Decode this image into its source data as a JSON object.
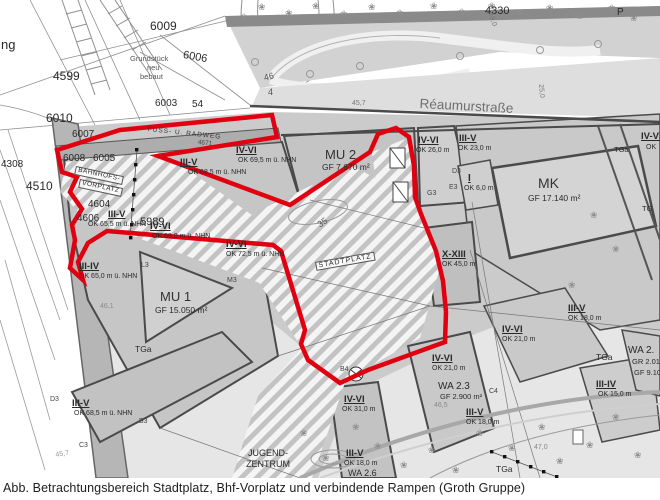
{
  "figure": {
    "caption": "Abb. Betrachtungsbereich Stadtplatz, Bhf-Vorplatz und verbindende Rampen (Groth Gruppe)"
  },
  "colors": {
    "study_area_outline": "#e10010",
    "street_fill": "#dedede",
    "parcel_dark_line": "#4a4a4a"
  },
  "map": {
    "street_name": "Réaumurstraße",
    "labels": [
      {
        "t": "ng",
        "x": 1,
        "y": 38,
        "s": 13
      },
      {
        "t": "6009",
        "x": 150,
        "y": 20,
        "s": 12
      },
      {
        "t": "4599",
        "x": 53,
        "y": 70,
        "s": 12
      },
      {
        "t": "Grundstück",
        "x": 130,
        "y": 55,
        "s": 7.5,
        "c": "#555"
      },
      {
        "t": "neu",
        "x": 147,
        "y": 64,
        "s": 7.5,
        "c": "#555"
      },
      {
        "t": "bebaut",
        "x": 140,
        "y": 73,
        "s": 7.5,
        "c": "#555"
      },
      {
        "t": "6006",
        "x": 184,
        "y": 50,
        "s": 11,
        "r": 10
      },
      {
        "t": "6003",
        "x": 155,
        "y": 99,
        "s": 10
      },
      {
        "t": "54",
        "x": 192,
        "y": 100,
        "s": 10
      },
      {
        "t": "6010",
        "x": 46,
        "y": 112,
        "s": 12
      },
      {
        "t": "6007",
        "x": 72,
        "y": 130,
        "s": 10
      },
      {
        "t": "4330",
        "x": 485,
        "y": 6,
        "s": 11
      },
      {
        "t": "P",
        "x": 617,
        "y": 8,
        "s": 10
      },
      {
        "t": "Réaumurstraße",
        "x": 420,
        "y": 97,
        "s": 13.5,
        "c": "#6f6f6f",
        "r": 3
      },
      {
        "t": "45,7",
        "x": 352,
        "y": 100,
        "s": 7,
        "c": "#777"
      },
      {
        "t": "46",
        "x": 263,
        "y": 74,
        "s": 9,
        "c": "#555",
        "r": -15
      },
      {
        "t": "4",
        "x": 268,
        "y": 88,
        "s": 9,
        "c": "#555"
      },
      {
        "t": "FUSS- U. RADWEG",
        "x": 148,
        "y": 127,
        "s": 6.5,
        "r": 6,
        "ls": 1,
        "c": "#333"
      },
      {
        "t": "4671",
        "x": 198,
        "y": 140,
        "s": 6.5,
        "r": 6,
        "c": "#444"
      },
      {
        "t": "4308",
        "x": 1,
        "y": 160,
        "s": 10
      },
      {
        "t": "6008",
        "x": 63,
        "y": 154,
        "s": 10
      },
      {
        "t": "6005",
        "x": 93,
        "y": 154,
        "s": 10
      },
      {
        "t": "BAHNHOFS-",
        "x": 76,
        "y": 166,
        "s": 6.5,
        "r": 12,
        "ls": 0.5,
        "box": 1
      },
      {
        "t": "VORPLATZ",
        "x": 80,
        "y": 179,
        "s": 6.5,
        "r": 12,
        "ls": 0.5,
        "box": 1
      },
      {
        "t": "4510",
        "x": 26,
        "y": 180,
        "s": 12
      },
      {
        "t": "4604",
        "x": 88,
        "y": 200,
        "s": 10
      },
      {
        "t": "4606",
        "x": 77,
        "y": 214,
        "s": 10
      },
      {
        "t": "5989",
        "x": 140,
        "y": 217,
        "s": 11
      },
      {
        "t": "III-V",
        "x": 180,
        "y": 158,
        "s": 9.5,
        "w": 1,
        "u": 1
      },
      {
        "t": "OK 68,5 m ü. NHN",
        "x": 188,
        "y": 169,
        "s": 7
      },
      {
        "t": "IV-VI",
        "x": 236,
        "y": 146,
        "s": 9.5,
        "w": 1,
        "u": 1
      },
      {
        "t": "OK 69,5 m ü. NHN",
        "x": 238,
        "y": 157,
        "s": 7
      },
      {
        "t": "MU 2",
        "x": 325,
        "y": 148,
        "s": 13,
        "c": "#333"
      },
      {
        "t": "GF 7.670 m²",
        "x": 322,
        "y": 163,
        "s": 8.5
      },
      {
        "t": "IV-VI",
        "x": 418,
        "y": 136,
        "s": 9.5,
        "w": 1,
        "u": 1
      },
      {
        "t": "OK 26,0 m",
        "x": 416,
        "y": 147,
        "s": 7
      },
      {
        "t": "III-V",
        "x": 459,
        "y": 134,
        "s": 9.5,
        "w": 1,
        "u": 1
      },
      {
        "t": "OK 23,0 m",
        "x": 458,
        "y": 145,
        "s": 7
      },
      {
        "t": "I",
        "x": 468,
        "y": 174,
        "s": 10,
        "w": 1,
        "u": 1
      },
      {
        "t": "OK 6,0 m",
        "x": 464,
        "y": 185,
        "s": 7
      },
      {
        "t": "MK",
        "x": 538,
        "y": 176,
        "s": 14,
        "c": "#333"
      },
      {
        "t": "GF 17.140 m²",
        "x": 528,
        "y": 194,
        "s": 8.5
      },
      {
        "t": "TGa",
        "x": 614,
        "y": 146,
        "s": 7.5
      },
      {
        "t": "TG",
        "x": 642,
        "y": 205,
        "s": 7.5
      },
      {
        "t": "IV-VI",
        "x": 641,
        "y": 132,
        "s": 9.5,
        "w": 1,
        "u": 1
      },
      {
        "t": "OK",
        "x": 646,
        "y": 144,
        "s": 7
      },
      {
        "t": "X-XIII",
        "x": 442,
        "y": 250,
        "s": 9.5,
        "w": 1,
        "u": 1
      },
      {
        "t": "OK 45,0 m",
        "x": 442,
        "y": 261,
        "s": 7
      },
      {
        "t": "IV-VI",
        "x": 226,
        "y": 240,
        "s": 9.5,
        "w": 1,
        "u": 1
      },
      {
        "t": "OK 72,5 m ü. NHN",
        "x": 226,
        "y": 251,
        "s": 7
      },
      {
        "t": "III-V",
        "x": 108,
        "y": 210,
        "s": 9.5,
        "w": 1,
        "u": 1
      },
      {
        "t": "OK 65,5 m ü. NHN",
        "x": 88,
        "y": 221,
        "s": 7
      },
      {
        "t": "IV-VI",
        "x": 150,
        "y": 222,
        "s": 9.5,
        "w": 1,
        "u": 1
      },
      {
        "t": "OK 69,0 m ü. NHN",
        "x": 152,
        "y": 233,
        "s": 7
      },
      {
        "t": "III-IV",
        "x": 79,
        "y": 262,
        "s": 9.5,
        "w": 1,
        "u": 1
      },
      {
        "t": "OK 65,0 m ü. NHN",
        "x": 79,
        "y": 273,
        "s": 7
      },
      {
        "t": "MU 1",
        "x": 160,
        "y": 290,
        "s": 13,
        "c": "#333"
      },
      {
        "t": "GF 15.050 m²",
        "x": 155,
        "y": 306,
        "s": 8.5
      },
      {
        "t": "46,1",
        "x": 100,
        "y": 303,
        "s": 7,
        "c": "#888"
      },
      {
        "t": "TGa",
        "x": 135,
        "y": 345,
        "s": 8.5
      },
      {
        "t": "35",
        "x": 316,
        "y": 222,
        "s": 9,
        "r": -35,
        "c": "#555"
      },
      {
        "t": "STADTPLATZ",
        "x": 315,
        "y": 262,
        "s": 7,
        "r": -10,
        "ls": 1,
        "box": 1
      },
      {
        "t": "III-V",
        "x": 72,
        "y": 399,
        "s": 9.5,
        "w": 1,
        "u": 1
      },
      {
        "t": "OK 68,5 m ü. NHN",
        "x": 74,
        "y": 410,
        "s": 7
      },
      {
        "t": "B3",
        "x": 139,
        "y": 418,
        "s": 7,
        "c": "#444"
      },
      {
        "t": "C3",
        "x": 79,
        "y": 442,
        "s": 7,
        "c": "#444"
      },
      {
        "t": "D3",
        "x": 50,
        "y": 396,
        "s": 7,
        "c": "#444"
      },
      {
        "t": "45,7",
        "x": 55,
        "y": 452,
        "s": 7,
        "c": "#999",
        "r": -10
      },
      {
        "t": "JUGEND-",
        "x": 248,
        "y": 449,
        "s": 9
      },
      {
        "t": "ZENTRUM",
        "x": 246,
        "y": 460,
        "s": 9
      },
      {
        "t": "B4",
        "x": 340,
        "y": 366,
        "s": 7,
        "c": "#444"
      },
      {
        "t": "IV-VI",
        "x": 344,
        "y": 395,
        "s": 9.5,
        "w": 1,
        "u": 1
      },
      {
        "t": "OK 31,0 m",
        "x": 342,
        "y": 406,
        "s": 7
      },
      {
        "t": "III-V",
        "x": 346,
        "y": 449,
        "s": 9.5,
        "w": 1,
        "u": 1
      },
      {
        "t": "OK 18,0 m",
        "x": 344,
        "y": 460,
        "s": 7
      },
      {
        "t": "WA 2.6",
        "x": 348,
        "y": 469,
        "s": 9
      },
      {
        "t": "IV-VI",
        "x": 432,
        "y": 354,
        "s": 9.5,
        "w": 1,
        "u": 1
      },
      {
        "t": "OK 21,0 m",
        "x": 432,
        "y": 365,
        "s": 7
      },
      {
        "t": "WA 2.3",
        "x": 438,
        "y": 382,
        "s": 10
      },
      {
        "t": "GF 2.900 m²",
        "x": 440,
        "y": 393,
        "s": 7.5
      },
      {
        "t": "C4",
        "x": 489,
        "y": 388,
        "s": 7,
        "c": "#444"
      },
      {
        "t": "III-V",
        "x": 466,
        "y": 408,
        "s": 9.5,
        "w": 1,
        "u": 1
      },
      {
        "t": "OK 18,0 m",
        "x": 466,
        "y": 419,
        "s": 7
      },
      {
        "t": "IV-VI",
        "x": 502,
        "y": 325,
        "s": 9.5,
        "w": 1,
        "u": 1
      },
      {
        "t": "OK 21,0 m",
        "x": 502,
        "y": 336,
        "s": 7
      },
      {
        "t": "III-V",
        "x": 568,
        "y": 304,
        "s": 9.5,
        "w": 1,
        "u": 1
      },
      {
        "t": "OK 18,0 m",
        "x": 568,
        "y": 315,
        "s": 7
      },
      {
        "t": "TGa",
        "x": 596,
        "y": 353,
        "s": 8.5
      },
      {
        "t": "WA 2.",
        "x": 628,
        "y": 346,
        "s": 10
      },
      {
        "t": "GR 2.010",
        "x": 632,
        "y": 358,
        "s": 7.5
      },
      {
        "t": "GF 9.100",
        "x": 634,
        "y": 369,
        "s": 7.5
      },
      {
        "t": "III-IV",
        "x": 596,
        "y": 380,
        "s": 9.5,
        "w": 1,
        "u": 1
      },
      {
        "t": "OK 15,0 m",
        "x": 598,
        "y": 391,
        "s": 7
      },
      {
        "t": "TGa",
        "x": 496,
        "y": 465,
        "s": 8.5
      },
      {
        "t": "47,0",
        "x": 534,
        "y": 444,
        "s": 7,
        "c": "#888"
      },
      {
        "t": "46,5",
        "x": 434,
        "y": 402,
        "s": 7,
        "c": "#888"
      },
      {
        "t": "M3",
        "x": 227,
        "y": 277,
        "s": 7,
        "c": "#444"
      },
      {
        "t": "L3",
        "x": 141,
        "y": 262,
        "s": 7,
        "c": "#444"
      },
      {
        "t": "G3",
        "x": 427,
        "y": 190,
        "s": 7,
        "c": "#444"
      },
      {
        "t": "E3",
        "x": 449,
        "y": 184,
        "s": 7,
        "c": "#444"
      },
      {
        "t": "D3",
        "x": 452,
        "y": 168,
        "s": 7,
        "c": "#444"
      },
      {
        "t": "18,0",
        "x": 494,
        "y": 12,
        "s": 7,
        "r": 75,
        "c": "#777"
      },
      {
        "t": "25,0",
        "x": 544,
        "y": 84,
        "s": 7,
        "r": 85,
        "c": "#777"
      }
    ]
  }
}
